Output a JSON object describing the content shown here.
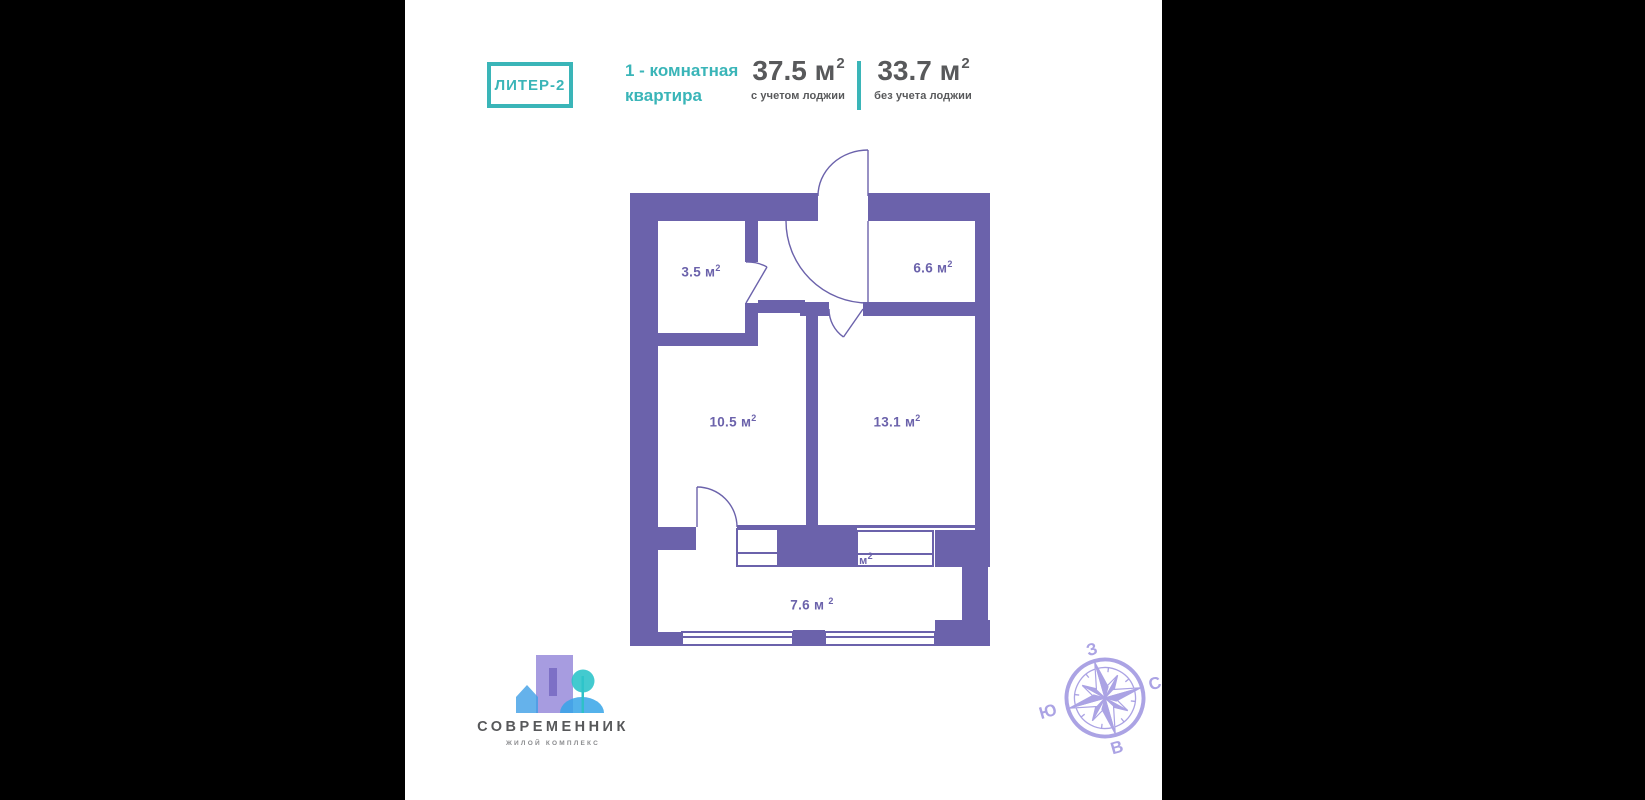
{
  "colors": {
    "background": "#000000",
    "canvas": "#ffffff",
    "teal_accent": "#3ab5b8",
    "dark_text": "#58595b",
    "plan_purple": "#6b62ab",
    "compass_lavender": "#aba3e4",
    "logo_purple": "#a79ce0",
    "logo_blue": "#3f9fe6",
    "logo_teal": "#2fc4ca"
  },
  "header": {
    "badge_label": "ЛИТЕР-2",
    "apartment_type_line1": "1 - комнатная",
    "apartment_type_line2": "квартира",
    "areas": [
      {
        "value": "37.5 м",
        "sup": "2",
        "caption": "с учетом лоджии"
      },
      {
        "value": "33.7 м",
        "sup": "2",
        "caption": "без учета лоджии"
      }
    ]
  },
  "plan": {
    "rooms": [
      {
        "id": "bathroom",
        "label": "3.5 м",
        "sup": "2"
      },
      {
        "id": "kitchen",
        "label": "6.6 м",
        "sup": "2"
      },
      {
        "id": "living-room",
        "label": "10.5 м",
        "sup": "2"
      },
      {
        "id": "bedroom",
        "label": "13.1 м",
        "sup": "2"
      },
      {
        "id": "loggia",
        "label": "7.6 м",
        "sup": "2"
      },
      {
        "id": "hidden-fragment",
        "label": "м",
        "sup": "2"
      }
    ]
  },
  "logo": {
    "title": "СОВРЕМЕННИК",
    "subtitle": "ЖИЛОЙ КОМПЛЕКС"
  },
  "compass": {
    "top": "З",
    "right": "С",
    "left": "Ю",
    "bottom": "В"
  }
}
